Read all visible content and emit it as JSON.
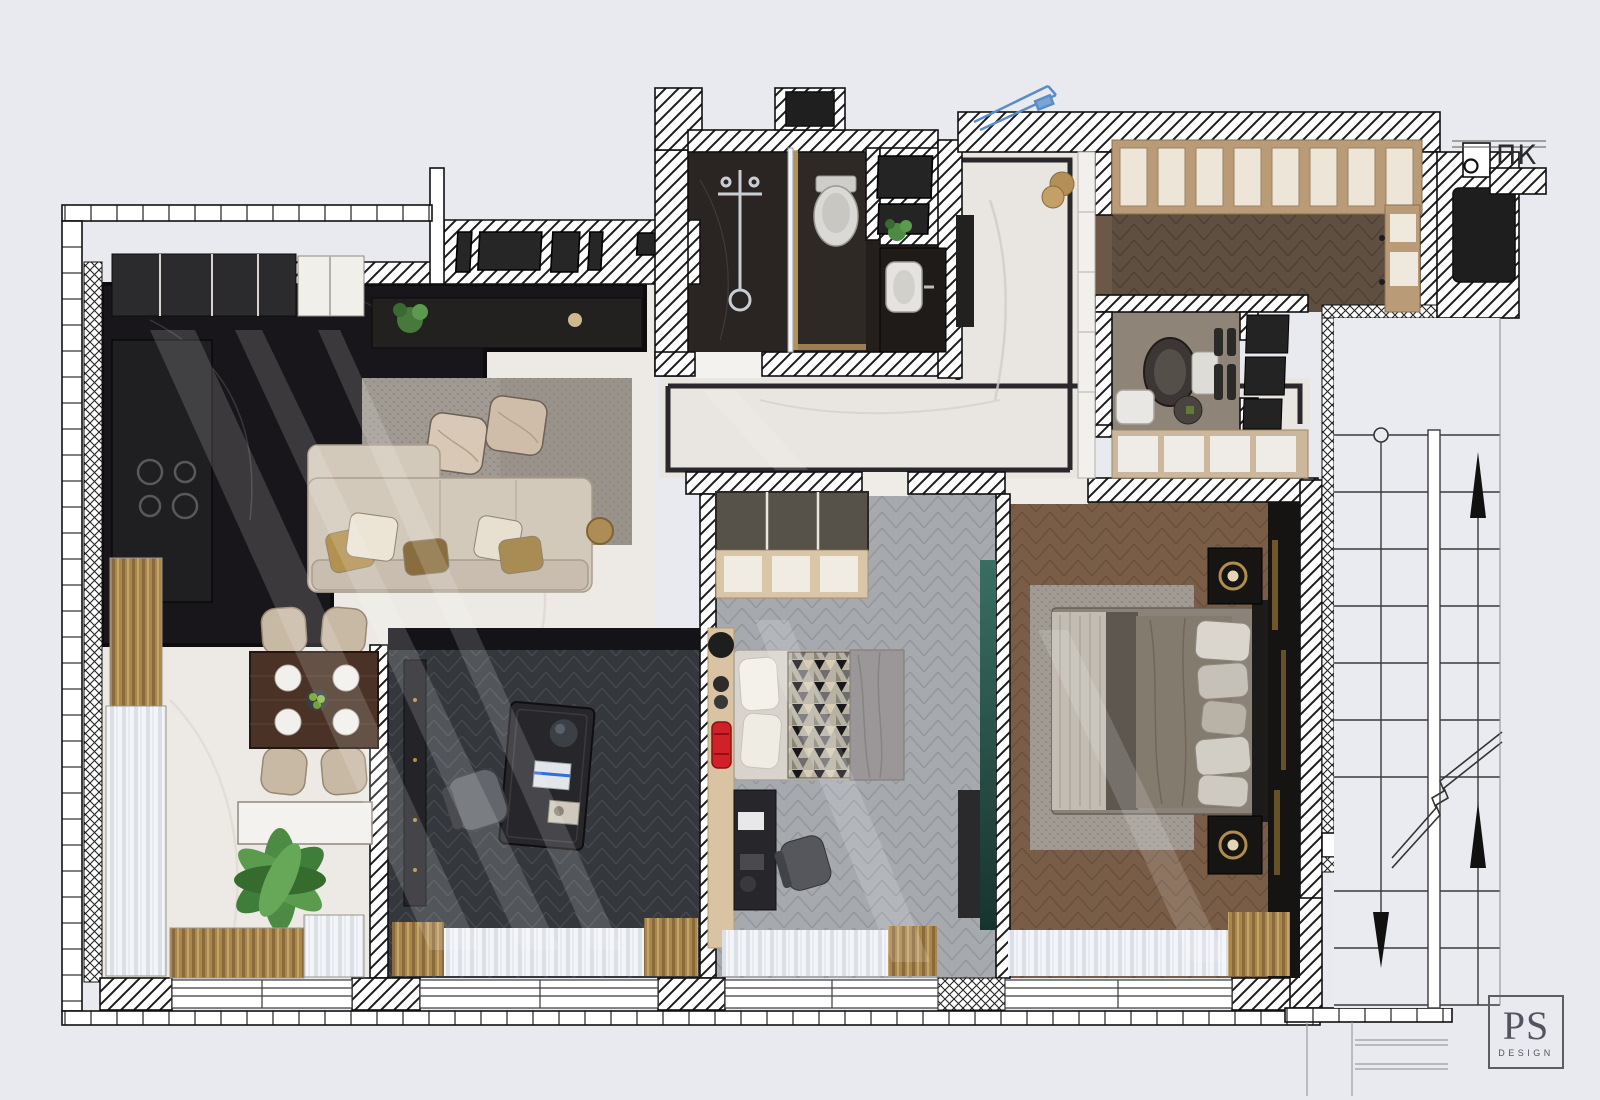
{
  "labels": {
    "fire_hydrant": "ПК",
    "logo_initials": "PS",
    "logo_subtitle": "DESIGN"
  },
  "palette": {
    "background": "#e9eaef",
    "wall_white": "#ffffff",
    "hatch_line": "#1c1c1c",
    "marble_light": "#edeae5",
    "marble_dark": "#18161a",
    "wood_master": "#7a5d46",
    "wood_wardrobe": "#5f4f41",
    "kids_floor_gray": "#a6aaaf",
    "office_floor": "#34373c",
    "tan_shelving": "#c0a37e",
    "sofa_beige": "#d3c9ba",
    "gold_accent": "#ab8a52",
    "teal_glass": "#2e5b52",
    "red_toy_car": "#cf2126",
    "plant_green": "#4d8a43",
    "logo_gray": "#55545e",
    "blue_sketch": "#5b8cc8"
  },
  "rooms": [
    "kitchen",
    "living-room",
    "dining-area",
    "home-office",
    "kids-bedroom",
    "master-bedroom",
    "bathroom",
    "wc",
    "entry-hall",
    "corridor",
    "walk-in-closet",
    "stairwell",
    "elevator-shaft"
  ]
}
